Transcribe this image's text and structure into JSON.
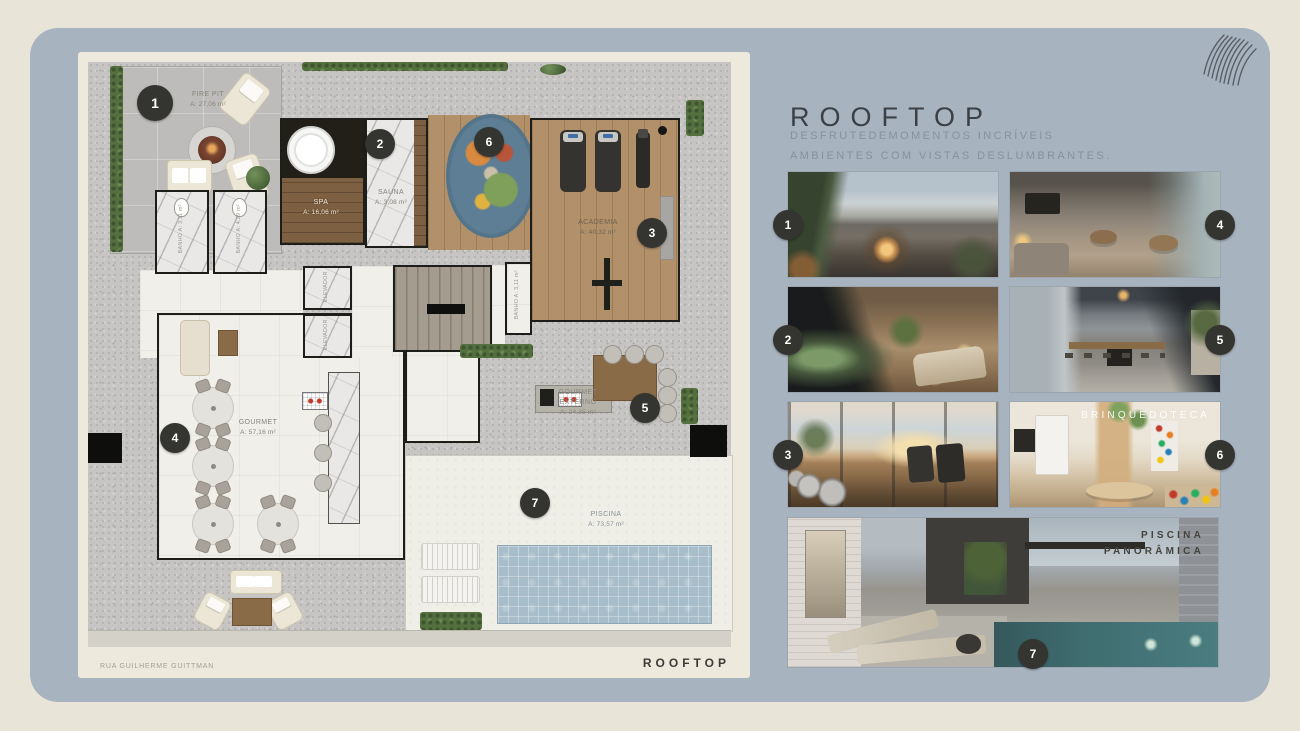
{
  "header": {
    "title": "ROOFTOP",
    "subtitle_line1": "DESFRUTEDEMOMENTOS INCRÍVEIS",
    "subtitle_line2": "AMBIENTES COM VISTAS DESLUMBRANTES.",
    "logo_icon": "wave-lines-logo"
  },
  "plan": {
    "street_label": "RUA GUILHERME GUITTMAN",
    "footer_label": "ROOFTOP",
    "rooms": [
      {
        "id": "fire-pit",
        "name": "FIRE PIT",
        "area": "A: 27,06 m²",
        "marker": "1"
      },
      {
        "id": "spa",
        "name": "SPA",
        "area": "A: 16,06 m²",
        "marker": "2"
      },
      {
        "id": "sauna",
        "name": "SAUNA",
        "area": "A: 3,08 m²"
      },
      {
        "id": "academia",
        "name": "ACADEMIA",
        "area": "A: 40,32 m²",
        "marker": "3"
      },
      {
        "id": "gourmet",
        "name": "GOURMET",
        "area": "A: 57,16 m²",
        "marker": "4"
      },
      {
        "id": "gourmet-externo",
        "name": "GOURMET EXTERNO",
        "area": "A: 24,35 m²",
        "marker": "5"
      },
      {
        "id": "brinquedoteca",
        "marker": "6"
      },
      {
        "id": "piscina",
        "name": "PISCINA",
        "area": "A: 73,57 m²",
        "marker": "7"
      },
      {
        "id": "banho-1",
        "name": "BANHO",
        "area": "A: 3,11 m²"
      },
      {
        "id": "banho-2",
        "name": "BANHO",
        "area": "A: 4,29 m²"
      },
      {
        "id": "banho-3",
        "name": "BANHO",
        "area": "A: 3,11 m²"
      },
      {
        "id": "elevador-1",
        "name": "ELEVADOR"
      },
      {
        "id": "elevador-2",
        "name": "ELEVADOR"
      }
    ]
  },
  "photos": [
    {
      "name": "fire-pit-terrace",
      "marker": "1"
    },
    {
      "name": "gourmet-lounge",
      "marker": "4"
    },
    {
      "name": "spa",
      "marker": "2"
    },
    {
      "name": "gourmet-externo",
      "marker": "5"
    },
    {
      "name": "academia",
      "marker": "3"
    },
    {
      "name": "brinquedoteca",
      "marker": "6",
      "overlay": "BRINQUEDOTECA"
    },
    {
      "name": "piscina-panoramica",
      "marker": "7",
      "overlay_line1": "PISCINA",
      "overlay_line2": "PANORÂMICA"
    }
  ],
  "colors": {
    "page_background": "#E9E4D8",
    "canvas": "#A7B3BF",
    "plan_panel": "#EDE9DD",
    "marker": "#343431",
    "title_text": "#3B4046",
    "subtitle_text": "#87929D"
  }
}
